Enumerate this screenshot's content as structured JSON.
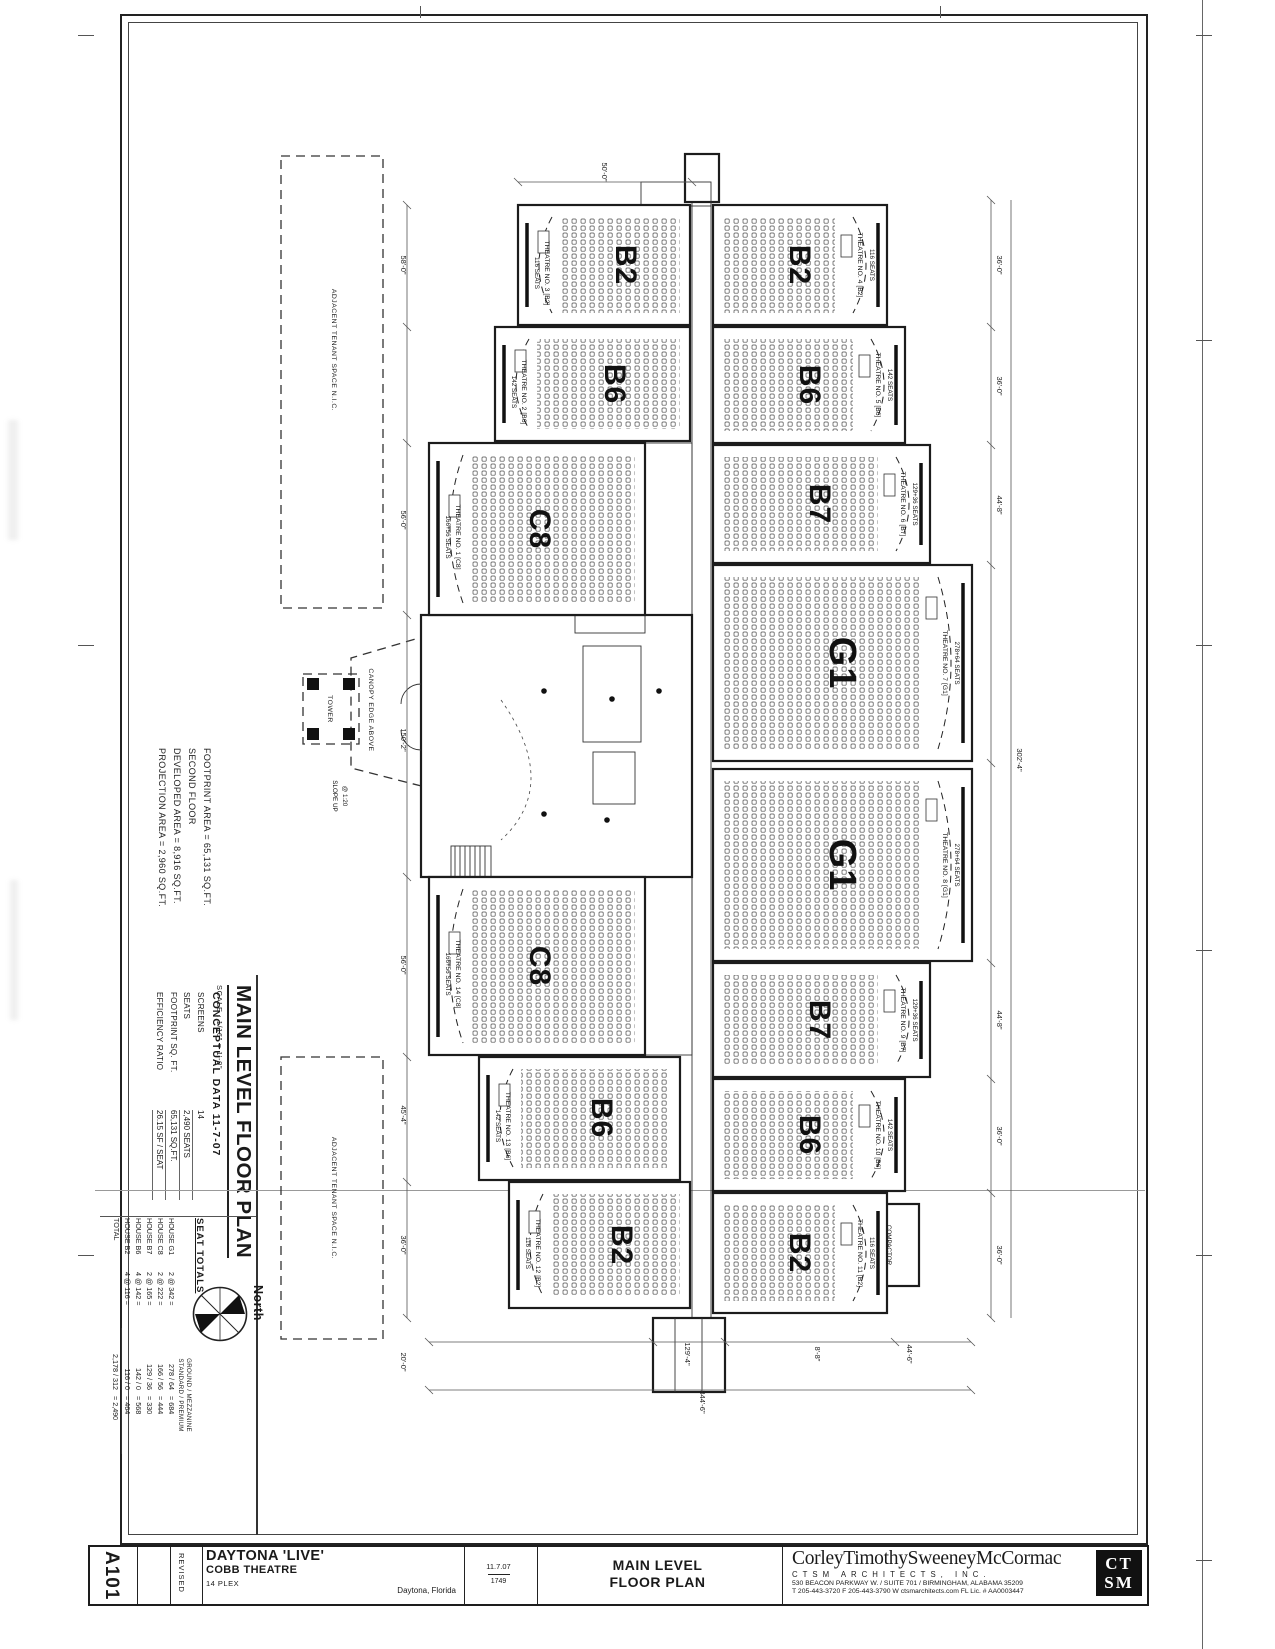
{
  "sheet": {
    "number": "A101",
    "revised": "REVISED",
    "project_line1": "DAYTONA 'LIVE'",
    "project_line2": "COBB THEATRE",
    "project_line3": "14 PLEX",
    "location": "Daytona, Florida",
    "date": "11.7.07",
    "job_no": "1749",
    "sheet_title_line1": "MAIN LEVEL",
    "sheet_title_line2": "FLOOR PLAN",
    "architect": {
      "name": "CorleyTimothySweeneyMcCormac",
      "firm": "CTSM ARCHITECTS, INC.",
      "address": "530 BEACON PARKWAY W. / SUITE 701 / BIRMINGHAM, ALABAMA 35209",
      "contact": "T 205-443-3720   F 205-443-3790   W ctsmarchitects.com   FL Lic. # AA0003447",
      "logo_top": "CT",
      "logo_bottom": "SM"
    }
  },
  "panel": {
    "areas": [
      "FOOTPRINT AREA = 65,131 SQ.FT.",
      "SECOND FLOOR",
      "DEVELOPED AREA = 8,916 SQ.FT.",
      "PROJECTION AREA = 2,960 SQ.FT."
    ],
    "plan_title": "MAIN LEVEL FLOOR PLAN",
    "plan_scale": "SCALE : 1/16\" = 1'-0\"",
    "conceptual_title": "CONCEPTUAL DATA  11-7-07",
    "conceptual": [
      [
        "SCREENS",
        "14"
      ],
      [
        "SEATS",
        "2,490 SEATS"
      ],
      [
        "FOOTPRINT SQ. FT.",
        "65,131 SQ.FT."
      ],
      [
        "EFFICIENCY RATIO",
        "26.15 SF / SEAT"
      ]
    ],
    "seat_totals_title": "SEAT TOTALS",
    "seat_header1": "GROUND / MEZZANINE",
    "seat_header2": "STANDARD / PREMIUM",
    "seat_rows": [
      [
        "HOUSE G1",
        "2 @ 342 =",
        "278 / 64",
        "= 684"
      ],
      [
        "HOUSE C8",
        "2 @ 222 =",
        "166 / 56",
        "= 444"
      ],
      [
        "HOUSE B7",
        "2 @ 165 =",
        "129 / 36",
        "= 330"
      ],
      [
        "HOUSE B6",
        "4 @ 142 =",
        "142 / 0",
        "= 568"
      ],
      [
        "HOUSE B2",
        "4 @ 116 =",
        "116 / 0",
        "= 464"
      ]
    ],
    "seat_total_row": [
      "TOTAL",
      "2,178 / 312",
      "= 2,490"
    ],
    "north": "North"
  },
  "plan": {
    "theatres": [
      {
        "house": "C8",
        "label": "THEATRE NO. 1 [C8]",
        "seats": "166+56 SEATS"
      },
      {
        "house": "B6",
        "label": "THEATRE NO. 2 [B6]",
        "seats": "142 SEATS"
      },
      {
        "house": "B2",
        "label": "THEATRE NO. 3 [B2]",
        "seats": "116 SEATS"
      },
      {
        "house": "B2",
        "label": "THEATRE NO. 4 [B2]",
        "seats": "116 SEATS"
      },
      {
        "house": "B6",
        "label": "THEATRE NO. 5 [B6]",
        "seats": "142 SEATS"
      },
      {
        "house": "B7",
        "label": "THEATRE NO. 6 [B7]",
        "seats": "129+36 SEATS"
      },
      {
        "house": "G1",
        "label": "THEATRE NO. 7 [G1]",
        "seats": "278+64 SEATS"
      },
      {
        "house": "G1",
        "label": "THEATRE NO. 8 [G1]",
        "seats": "278+64 SEATS"
      },
      {
        "house": "B7",
        "label": "THEATRE NO. 9 [B7]",
        "seats": "129+36 SEATS"
      },
      {
        "house": "B6",
        "label": "THEATRE NO. 10 [B6]",
        "seats": "142 SEATS"
      },
      {
        "house": "B2",
        "label": "THEATRE NO. 11 [B2]",
        "seats": "116 SEATS"
      },
      {
        "house": "B2",
        "label": "THEATRE NO. 12 [B2]",
        "seats": "116 SEATS"
      },
      {
        "house": "B6",
        "label": "THEATRE NO. 13 [B6]",
        "seats": "142 SEATS"
      },
      {
        "house": "C8",
        "label": "THEATRE NO. 14 [C8]",
        "seats": "166+56 SEATS"
      }
    ],
    "notes": {
      "tenant": "ADJACENT TENANT SPACE N.I.C.",
      "canopy": "CANOPY EDGE ABOVE",
      "tower": "TOWER",
      "slope1": "SLOPE UP",
      "slope2": "@ 1:20",
      "compactor": "COMPACTOR"
    },
    "dims": [
      "50'-0\"",
      "58'-0\"",
      "56'-0\"",
      "150'-2\"",
      "56'-0\"",
      "45'-4\"",
      "36'-0\"",
      "20'-0\"",
      "36'-0\"",
      "36'-0\"",
      "44'-8\"",
      "302'-4\"",
      "44'-8\"",
      "36'-0\"",
      "36'-0\"",
      "129'-4\"",
      "8'-8\"",
      "44'-6\"",
      "344'-6\""
    ]
  }
}
